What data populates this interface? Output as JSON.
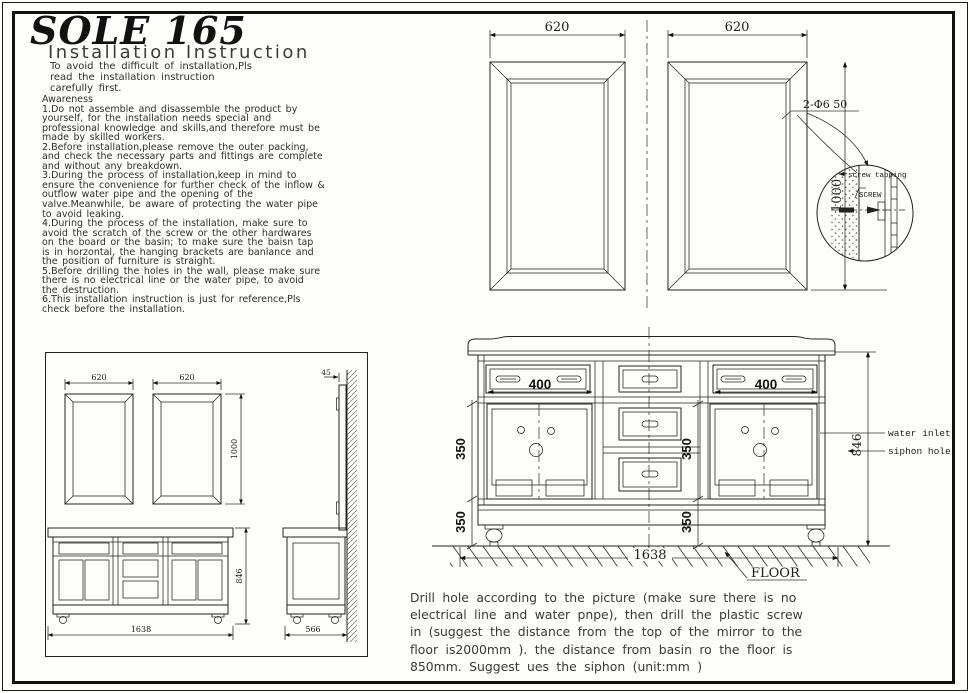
{
  "doc": {
    "title": "SOLE 165",
    "subtitle": "Installation  Instruction",
    "intro": "To avoid the difficult of installation,Pls\nread the installation instruction\ncarefully first.",
    "awareness_heading": "Awareness",
    "awareness_items": [
      "1.Do not assemble and disassemble the product by\nyourself, for the installation needs special and\nprofessional knowledge and skills,and therefore must be\nmade by skilled workers.",
      "2.Before installation,please remove the outer packing,\nand check the necessary parts and fittings are complete\nand without any breakdown.",
      "3.During the process of installation,keep in mind to\nensure the convenience for further check of the inflow &\noutflow water pipe and the opening of the\nvalve.Meanwhile, be aware of protecting the water pipe\nto avoid leaking.",
      "4.During the process of the installation, make sure to\navoid the scratch of the screw or the other hardwares\non the board or the basin; to make sure the baisn tap\nis in horzontal, the hanging brackets are banlance and\nthe position of furniture is straight.",
      "5.Before drilling the holes in the wall, please make sure\nthere is no electrical line or the water pipe, to avoid\nthe destruction.",
      "6.This installation instruction is just for reference,Pls\ncheck before the installation."
    ],
    "drill_note": "Drill hole according to the picture (make sure there is no\nelectrical line and water pnpe), then drill the plastic screw\nin (suggest the distance from the top of the mirror to the\nfloor is2000mm ). the distance from basin ro the floor is\n850mm. Suggest ues the siphon (unit:mm )"
  },
  "mirror_drawing": {
    "dim_width_left": "620",
    "dim_width_right": "620",
    "dim_height": "1000",
    "screw_spec": "2-Φ6  50",
    "detail": {
      "screw_tapping": "screw tapping",
      "screw": "SCREW"
    }
  },
  "vanity_front": {
    "dim_drawer_left": "400",
    "dim_drawer_right": "400",
    "dim_door_height": "350",
    "dim_base_height": "350",
    "dim_door_height_mid": "350",
    "dim_base_height_mid": "350",
    "dim_total_height": "846",
    "dim_total_width": "1638",
    "label_water_inlet": "water inlet",
    "label_siphon_hole": "siphon hole",
    "label_floor": "FLOOR"
  },
  "overview": {
    "dim_mirror_left": "620",
    "dim_mirror_right": "620",
    "dim_mirror_height": "1000",
    "dim_wall_gap": "45",
    "dim_width": "1638",
    "dim_height": "846",
    "dim_depth": "566"
  }
}
